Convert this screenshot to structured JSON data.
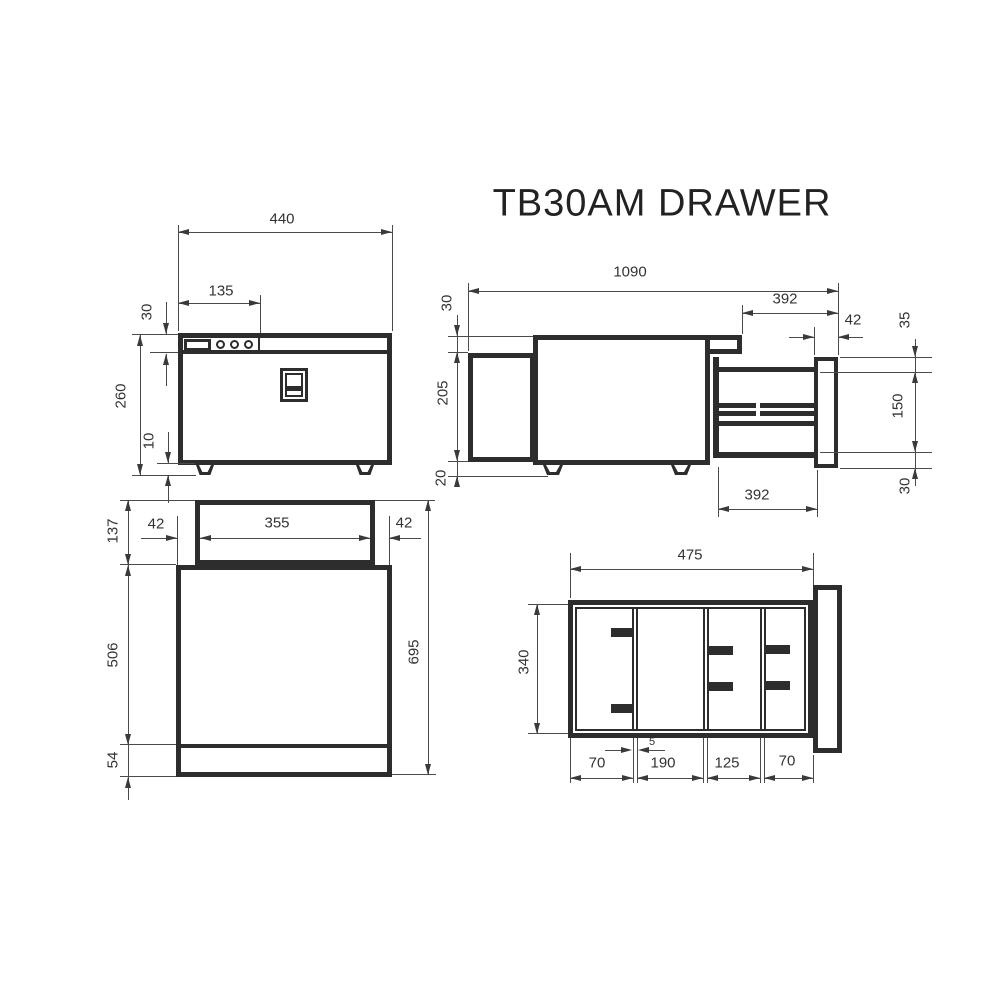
{
  "title": "TB30AM DRAWER",
  "front_view": {
    "width": "440",
    "control_width": "135",
    "panel_height": "30",
    "total_height": "260",
    "foot_height": "10"
  },
  "side_view": {
    "total_length": "1090",
    "ext_top": "392",
    "front_thickness": "42",
    "top_offset": "35",
    "rail_height": "150",
    "bottom_offset": "30",
    "lid_height": "30",
    "body_height": "205",
    "foot_height": "20",
    "ext_bottom": "392"
  },
  "plan_view": {
    "back_width": "355",
    "left_offset": "42",
    "right_offset": "42",
    "back_depth": "137",
    "body_depth": "506",
    "front_depth": "54",
    "total_depth": "695"
  },
  "drawer_view": {
    "width": "475",
    "depth": "340",
    "comp1": "70",
    "comp2": "190",
    "comp3": "125",
    "comp4": "70",
    "divider": "5"
  }
}
